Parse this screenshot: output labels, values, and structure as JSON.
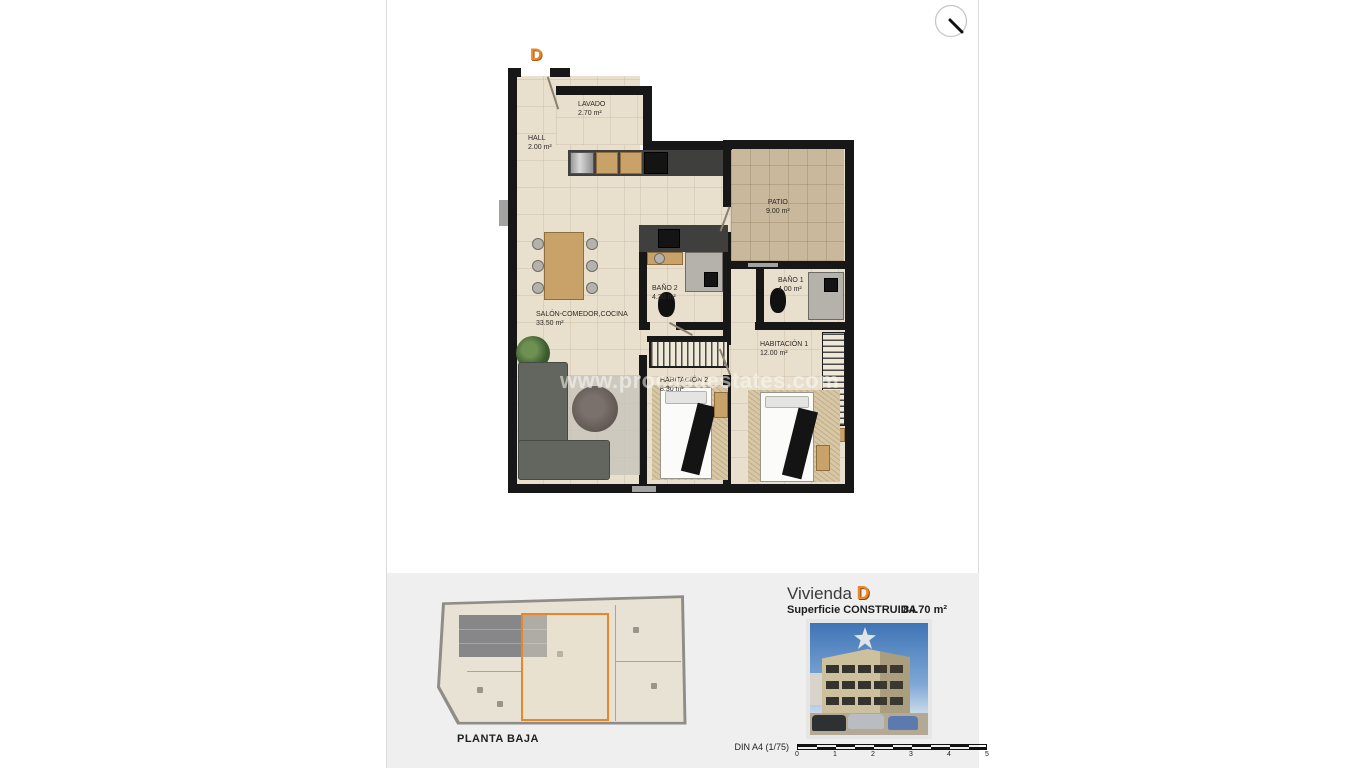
{
  "watermark": {
    "text": "www.procasaestates.com"
  },
  "viewer": {
    "zoom_icon": "magnifier"
  },
  "floorplan": {
    "unit_letter": "D",
    "rooms": [
      {
        "name": "HALL",
        "area": "2.00 m²"
      },
      {
        "name": "LAVADO",
        "area": "2.70 m²"
      },
      {
        "name": "PATIO",
        "area": "9.00 m²"
      },
      {
        "name": "BAÑO 2",
        "area": "4.30 m²"
      },
      {
        "name": "BAÑO 1",
        "area": "4.00 m²"
      },
      {
        "name": "SALÓN-COMEDOR,COCINA",
        "area": "33.50 m²"
      },
      {
        "name": "HABITACIÓN 1",
        "area": "12.00 m²"
      },
      {
        "name": "HABITACIÓN 2",
        "area": "8.30 m²"
      }
    ]
  },
  "footer": {
    "site_plan_label": "PLANTA BAJA",
    "unit_title_prefix": "Vivienda",
    "unit_letter": "D",
    "surface_label": "Superficie CONSTRUIDA",
    "surface_value": "84.70 m²",
    "scale_label": "DIN A4 (1/75)",
    "scale_ticks": [
      "0",
      "1",
      "2",
      "3",
      "4",
      "5"
    ]
  },
  "colors": {
    "accent_orange": "#e8872b",
    "wall_black": "#171717",
    "floor_beige": "#e9dfcd",
    "patio_tan": "#c9b89b",
    "footer_gray": "#efeff0"
  }
}
